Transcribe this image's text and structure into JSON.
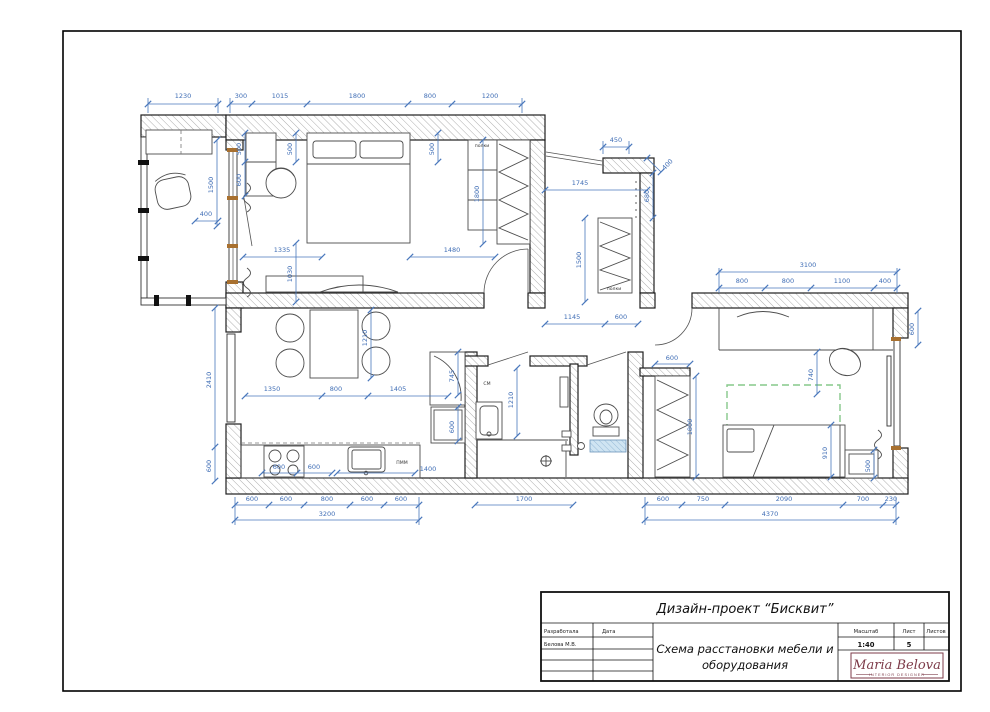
{
  "title_block": {
    "project_title": "Дизайн-проект “Бисквит”",
    "drawing_title_line1": "Схема расстановки мебели и",
    "drawing_title_line2": "оборудования",
    "developer_label": "Разработала",
    "date_label": "Дата",
    "developer_name": "Белова М.В.",
    "scale_label": "Масштаб",
    "scale_value": "1:40",
    "sheet_label": "Лист",
    "sheet_value": "5",
    "sheets_label": "Листов",
    "logo": {
      "name": "Maria Belova",
      "subtitle": "INTERIOR DESIGNER"
    }
  },
  "plan_labels": {
    "shelves_bedroom": "полки",
    "shelves_hall": "полки",
    "washing_machine": "СМ",
    "dishwasher": "ПММ"
  },
  "dimensions": {
    "top": {
      "d1230": "1230",
      "d300": "300",
      "d1015": "1015",
      "d1800": "1800",
      "d800": "800",
      "d1200": "1200"
    },
    "balcony": {
      "d1500": "1500",
      "d400": "400"
    },
    "bedroom": {
      "d500a": "500",
      "d600": "600",
      "d500b": "500",
      "d500c": "500",
      "d1800w": "1800",
      "d1335": "1335",
      "d1480": "1480",
      "d1030": "1030"
    },
    "entry": {
      "d450": "450",
      "d400": "400",
      "d680": "680",
      "d1745": "1745"
    },
    "hall": {
      "d1500": "1500",
      "d1145": "1145",
      "d600": "600"
    },
    "children": {
      "d3100": "3100",
      "d800a": "800",
      "d800b": "800",
      "d1100": "1100",
      "d400": "400",
      "d600_right": "600",
      "d740": "740",
      "d1800": "1800",
      "d910": "910",
      "d500": "500",
      "d600_wardrobe": "600",
      "d600_b": "600",
      "d750": "750",
      "d2090": "2090",
      "d700": "700",
      "d230": "230",
      "d4370": "4370"
    },
    "kitchen": {
      "d1350": "1350",
      "d800": "800",
      "d1405": "1405",
      "d1210": "1210",
      "d745": "745",
      "d600_fridge": "600",
      "d2410": "2410",
      "d600_left": "600",
      "d600_s1": "600",
      "d600_s2": "600",
      "d1400": "1400",
      "d600_b1": "600",
      "d600_b2": "600",
      "d800_b": "800",
      "d600_b3": "600",
      "d600_b4": "600",
      "d3200": "3200"
    },
    "bathroom": {
      "d1210": "1210",
      "d1700": "1700"
    }
  },
  "colors": {
    "dimension_blue": "#4a78bc",
    "logo_maroon": "#7d3b49",
    "rug_green": "#86c88a",
    "window_wood": "#a8702f",
    "wc_shelf_blue": "#cfe4f2"
  }
}
